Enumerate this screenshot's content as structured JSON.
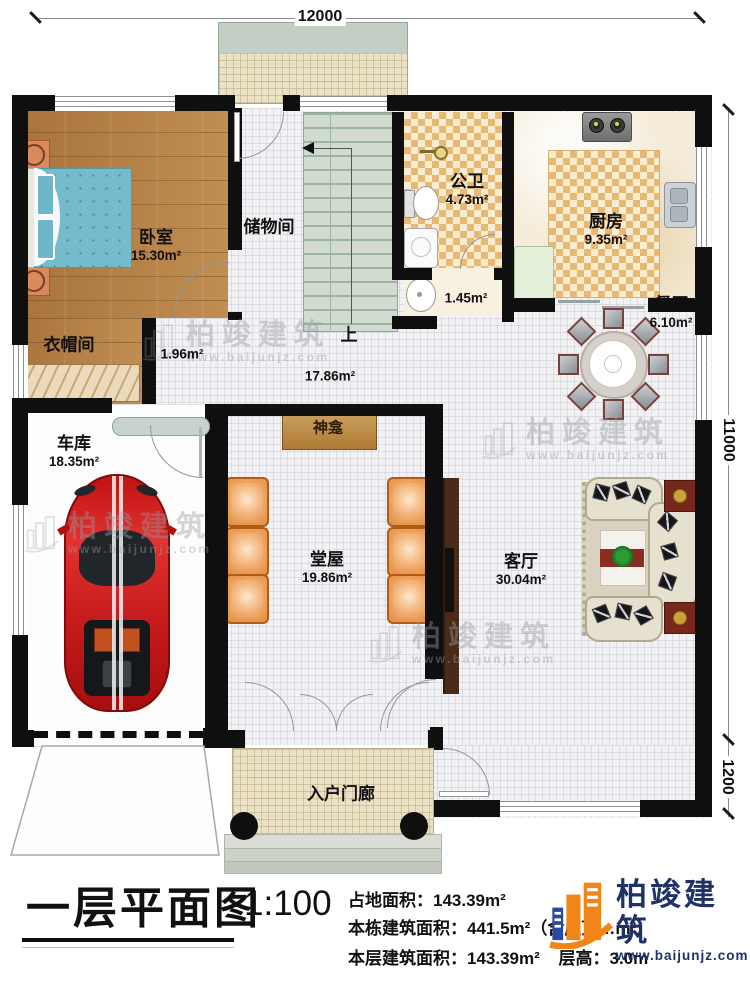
{
  "title_block": {
    "title": "一层平面图",
    "scale": "1:100",
    "line_land": "占地面积：143.39m²",
    "line_total": "本栋建筑面积：441.5m²（含屋顶…m²）",
    "line_floor": "本层建筑面积：143.39m²",
    "line_height": "层高：3.0m"
  },
  "dimensions": {
    "top": "12000",
    "right": "11000",
    "right_lower": "1200"
  },
  "rooms": {
    "bedroom": {
      "name": "卧室",
      "area": "15.30m²"
    },
    "cloakroom": {
      "name": "衣帽间"
    },
    "storage": {
      "name": "储物间"
    },
    "bathroom": {
      "name": "公卫",
      "area": "4.73m²"
    },
    "wash": {
      "area": "1.45m²"
    },
    "kitchen": {
      "name": "厨房",
      "area": "9.35m²"
    },
    "dining": {
      "name": "餐厅",
      "area": "6.10m²"
    },
    "corridor": {
      "area": "1.96m²"
    },
    "hallway": {
      "area": "17.86m²"
    },
    "stairs": {
      "label": "上"
    },
    "garage": {
      "name": "车库",
      "area": "18.35m²"
    },
    "tangwu": {
      "name": "堂屋",
      "area": "19.86m²"
    },
    "shrine": {
      "name": "神龛"
    },
    "living": {
      "name": "客厅",
      "area": "30.04m²"
    },
    "porch": {
      "name": "入户门廊"
    }
  },
  "brand": {
    "name": "柏竣建筑",
    "url": "www.baijunjz.com"
  },
  "colors": {
    "wall": "#0f0f0f",
    "wood": "#b07b44",
    "checker": "#e9b873",
    "accent_orange": "#f08519",
    "brand_navy": "#1e3268",
    "stair": "#d1dbd0"
  }
}
